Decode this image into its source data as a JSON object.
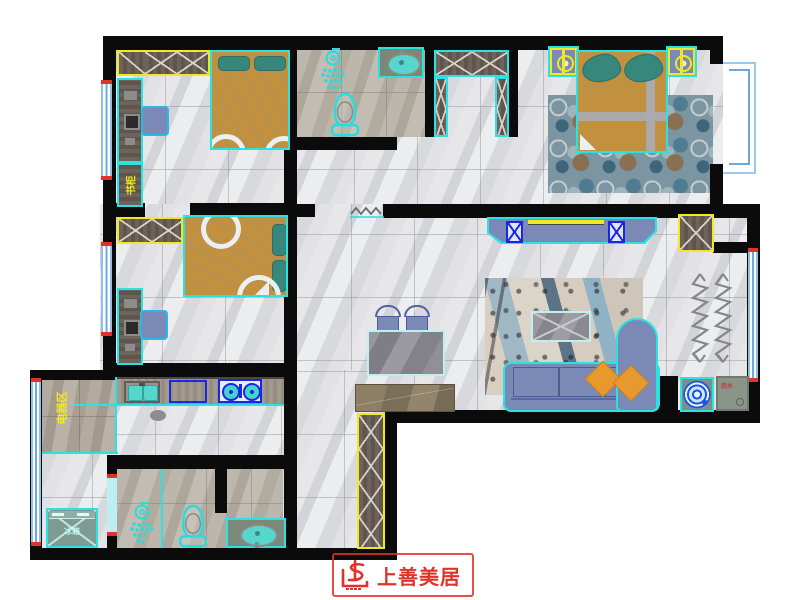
{
  "type": "residential-floor-plan",
  "logo": {
    "brand": "上善美居"
  },
  "labels": {
    "bedroom_cabinet": "书柜",
    "appliance_zone": "电器区",
    "fridge": "冰箱",
    "water_heater": "热水"
  },
  "colors": {
    "wall": "#0b0b0c",
    "furniture_outline": "#2ae2e2",
    "cabinet_highlight": "#f0e822",
    "bed_tan": "#c2913f",
    "pillow_teal": "#37877d",
    "sofa_blue": "#7a89b6",
    "cushion_orange": "#e8992e",
    "window_blue": "#8fc0ea",
    "stove_blue": "#1726e8",
    "logo_red": "#e03228"
  }
}
